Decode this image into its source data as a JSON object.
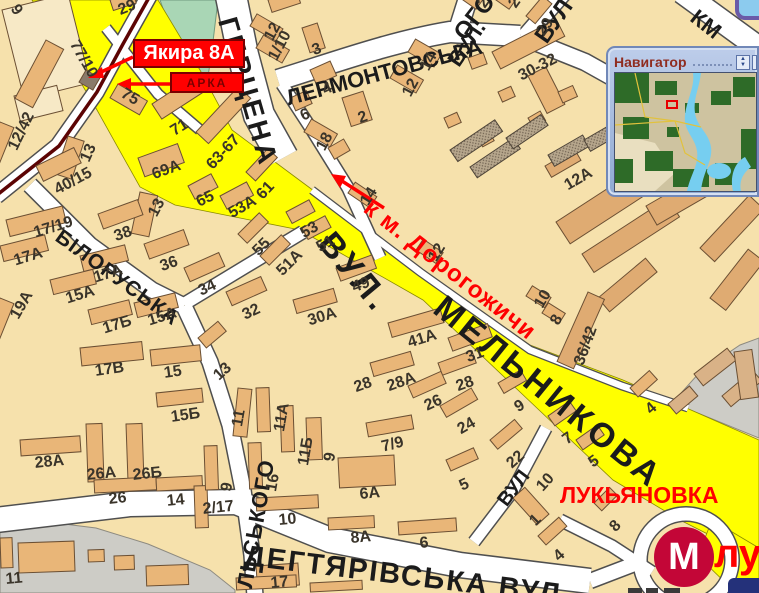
{
  "colors": {
    "background": "#F6E1AC",
    "building": "#E9B678",
    "building_pale": "#F7E9C6",
    "building_dark_tan": "#DFAB72",
    "road_white": "#FFFFFF",
    "main_road_yellow": "#FFFF00",
    "park_green": "#A9D6B5",
    "industrial_gray": "#CDCCC6",
    "tram_line": "#5C0404",
    "annotation_red": "#FF0000",
    "metro_red": "#C30637",
    "navigator_frame_blue": "#8FA9D2",
    "navigator_title_color": "#8F2C20"
  },
  "navigator": {
    "title": "Навигатор",
    "spinner_up": "▲",
    "spinner_down": "▼",
    "marker": "red-rectangle"
  },
  "annotations": {
    "address_callout": "Якира 8А",
    "arch_callout": "АРКА",
    "direction_note": "к м. Дорогожичи",
    "district": "ЛУКЬЯНОВКА",
    "metro_letter": "М",
    "metro_station_fragment": "лу"
  },
  "street_labels": [
    {
      "t": "ГЕРЦЕНА",
      "x": 240,
      "y": 14,
      "r": 74,
      "s": 28,
      "ls": 3
    },
    {
      "t": "ЛЕРМОНТОВСЬКА",
      "x": 284,
      "y": 88,
      "r": -15,
      "s": 22
    },
    {
      "t": "ВУЛ.",
      "x": 444,
      "y": 58,
      "r": -56,
      "s": 22
    },
    {
      "t": "ОГО",
      "x": 450,
      "y": 30,
      "r": -52,
      "s": 24
    },
    {
      "t": "ВУЛ",
      "x": 531,
      "y": 34,
      "r": -55,
      "s": 24
    },
    {
      "t": "КМ",
      "x": 700,
      "y": 6,
      "r": 38,
      "s": 22
    },
    {
      "t": "ВУЛ.",
      "x": 338,
      "y": 226,
      "r": 50,
      "s": 34,
      "ls": 4
    },
    {
      "t": "МЕЛЬНИКОВА",
      "x": 449,
      "y": 290,
      "r": 39,
      "s": 34,
      "ls": 4
    },
    {
      "t": "БІЛОРУСЬКА",
      "x": 64,
      "y": 226,
      "r": 36,
      "s": 21,
      "ls": 1
    },
    {
      "t": "ЛЬСЬКОГО",
      "x": 234,
      "y": 586,
      "r": -80,
      "s": 22,
      "ls": 1
    },
    {
      "t": "ДЕГТЯРІВСЬКА ВУЛ.",
      "x": 246,
      "y": 542,
      "r": 7,
      "s": 29,
      "ls": 2
    },
    {
      "t": "ВУЛ",
      "x": 494,
      "y": 498,
      "r": -53,
      "s": 20
    }
  ],
  "building_numbers": [
    {
      "t": "9",
      "x": 20,
      "y": 2,
      "r": 55
    },
    {
      "t": "77/10",
      "x": 80,
      "y": 38,
      "r": 60
    },
    {
      "t": "75",
      "x": 126,
      "y": 86,
      "r": 30
    },
    {
      "t": "29",
      "x": 116,
      "y": 4,
      "r": -22
    },
    {
      "t": "12",
      "x": 262,
      "y": 36,
      "r": -62
    },
    {
      "t": "1/10",
      "x": 266,
      "y": 56,
      "r": -62
    },
    {
      "t": "3",
      "x": 310,
      "y": 44,
      "r": -20
    },
    {
      "t": "4",
      "x": 320,
      "y": 84,
      "r": -25
    },
    {
      "t": "6",
      "x": 298,
      "y": 110,
      "r": -25
    },
    {
      "t": "2",
      "x": 356,
      "y": 112,
      "r": -20
    },
    {
      "t": "12",
      "x": 400,
      "y": 92,
      "r": -62
    },
    {
      "t": "14",
      "x": 418,
      "y": 66,
      "r": -62
    },
    {
      "t": "23",
      "x": 475,
      "y": 2,
      "r": -55
    },
    {
      "t": "25",
      "x": 506,
      "y": 2,
      "r": -55
    },
    {
      "t": "29",
      "x": 534,
      "y": 30,
      "r": -55
    },
    {
      "t": "30-32",
      "x": 516,
      "y": 70,
      "r": -27
    },
    {
      "t": "18",
      "x": 314,
      "y": 146,
      "r": -62
    },
    {
      "t": "71",
      "x": 168,
      "y": 126,
      "r": -32
    },
    {
      "t": "69А",
      "x": 150,
      "y": 168,
      "r": -20
    },
    {
      "t": "63-67",
      "x": 204,
      "y": 162,
      "r": -47
    },
    {
      "t": "65",
      "x": 194,
      "y": 196,
      "r": -25
    },
    {
      "t": "61",
      "x": 254,
      "y": 192,
      "r": -47
    },
    {
      "t": "53А",
      "x": 226,
      "y": 208,
      "r": -30
    },
    {
      "t": "13",
      "x": 146,
      "y": 212,
      "r": -62
    },
    {
      "t": "12/42",
      "x": 6,
      "y": 146,
      "r": -64
    },
    {
      "t": "13",
      "x": 78,
      "y": 158,
      "r": -66
    },
    {
      "t": "40/15",
      "x": 52,
      "y": 184,
      "r": -28
    },
    {
      "t": "38",
      "x": 112,
      "y": 230,
      "r": -20
    },
    {
      "t": "36",
      "x": 158,
      "y": 260,
      "r": -20
    },
    {
      "t": "34",
      "x": 196,
      "y": 285,
      "r": -25
    },
    {
      "t": "32",
      "x": 240,
      "y": 309,
      "r": -25
    },
    {
      "t": "17/19",
      "x": 32,
      "y": 226,
      "r": -17
    },
    {
      "t": "17А",
      "x": 12,
      "y": 254,
      "r": -17
    },
    {
      "t": "17А",
      "x": 92,
      "y": 271,
      "r": -17
    },
    {
      "t": "15А",
      "x": 64,
      "y": 292,
      "r": -17
    },
    {
      "t": "19А",
      "x": 8,
      "y": 314,
      "r": -60
    },
    {
      "t": "17Б",
      "x": 101,
      "y": 322,
      "r": -17
    },
    {
      "t": "15А",
      "x": 146,
      "y": 314,
      "r": -17
    },
    {
      "t": "55",
      "x": 250,
      "y": 248,
      "r": -45
    },
    {
      "t": "51А",
      "x": 274,
      "y": 268,
      "r": -45
    },
    {
      "t": "53",
      "x": 298,
      "y": 228,
      "r": -30
    },
    {
      "t": "51",
      "x": 314,
      "y": 242,
      "r": -30
    },
    {
      "t": "49",
      "x": 350,
      "y": 281,
      "r": -20
    },
    {
      "t": "30А",
      "x": 306,
      "y": 314,
      "r": -17
    },
    {
      "t": "41А",
      "x": 406,
      "y": 336,
      "r": -17
    },
    {
      "t": "31",
      "x": 464,
      "y": 351,
      "r": -20
    },
    {
      "t": "14",
      "x": 358,
      "y": 200,
      "r": -58
    },
    {
      "t": "12",
      "x": 426,
      "y": 256,
      "r": -58
    },
    {
      "t": "10",
      "x": 532,
      "y": 303,
      "r": -60
    },
    {
      "t": "8",
      "x": 548,
      "y": 320,
      "r": -60
    },
    {
      "t": "12А",
      "x": 562,
      "y": 180,
      "r": -30
    },
    {
      "t": "36/42",
      "x": 572,
      "y": 362,
      "r": -70
    },
    {
      "t": "11",
      "x": 230,
      "y": 425,
      "r": -80
    },
    {
      "t": "11А",
      "x": 272,
      "y": 430,
      "r": -80
    },
    {
      "t": "11Б",
      "x": 296,
      "y": 464,
      "r": -80
    },
    {
      "t": "9",
      "x": 322,
      "y": 460,
      "r": -80
    },
    {
      "t": "16",
      "x": 264,
      "y": 490,
      "r": -80
    },
    {
      "t": "9",
      "x": 219,
      "y": 490,
      "r": -80
    },
    {
      "t": "2/17",
      "x": 202,
      "y": 502,
      "r": -6
    },
    {
      "t": "14",
      "x": 166,
      "y": 494,
      "r": -6
    },
    {
      "t": "26",
      "x": 108,
      "y": 492,
      "r": -6
    },
    {
      "t": "26А",
      "x": 86,
      "y": 468,
      "r": -6
    },
    {
      "t": "26Б",
      "x": 132,
      "y": 468,
      "r": -6
    },
    {
      "t": "28А",
      "x": 34,
      "y": 456,
      "r": -6
    },
    {
      "t": "15Б",
      "x": 170,
      "y": 410,
      "r": -8
    },
    {
      "t": "15",
      "x": 163,
      "y": 366,
      "r": -8
    },
    {
      "t": "13",
      "x": 211,
      "y": 372,
      "r": -42
    },
    {
      "t": "17В",
      "x": 94,
      "y": 364,
      "r": -8
    },
    {
      "t": "28",
      "x": 352,
      "y": 381,
      "r": -20
    },
    {
      "t": "28А",
      "x": 385,
      "y": 380,
      "r": -20
    },
    {
      "t": "28",
      "x": 454,
      "y": 380,
      "r": -20
    },
    {
      "t": "26",
      "x": 422,
      "y": 400,
      "r": -25
    },
    {
      "t": "24",
      "x": 455,
      "y": 424,
      "r": -30
    },
    {
      "t": "22",
      "x": 504,
      "y": 460,
      "r": -42
    },
    {
      "t": "7/9",
      "x": 380,
      "y": 440,
      "r": -14
    },
    {
      "t": "5",
      "x": 457,
      "y": 480,
      "r": -25
    },
    {
      "t": "9",
      "x": 512,
      "y": 402,
      "r": -30
    },
    {
      "t": "7",
      "x": 560,
      "y": 435,
      "r": -35
    },
    {
      "t": "5",
      "x": 586,
      "y": 458,
      "r": -35
    },
    {
      "t": "4",
      "x": 643,
      "y": 406,
      "r": -42
    },
    {
      "t": "10",
      "x": 534,
      "y": 484,
      "r": -48
    },
    {
      "t": "1",
      "x": 527,
      "y": 518,
      "r": -45
    },
    {
      "t": "4",
      "x": 551,
      "y": 553,
      "r": -42
    },
    {
      "t": "8",
      "x": 607,
      "y": 524,
      "r": -45
    },
    {
      "t": "10",
      "x": 278,
      "y": 513,
      "r": -5
    },
    {
      "t": "8А",
      "x": 350,
      "y": 531,
      "r": -5
    },
    {
      "t": "6А",
      "x": 359,
      "y": 487,
      "r": -5
    },
    {
      "t": "6",
      "x": 419,
      "y": 536,
      "r": -5
    },
    {
      "t": "17",
      "x": 270,
      "y": 576,
      "r": -5
    },
    {
      "t": "11",
      "x": 5,
      "y": 572,
      "r": -5
    }
  ]
}
